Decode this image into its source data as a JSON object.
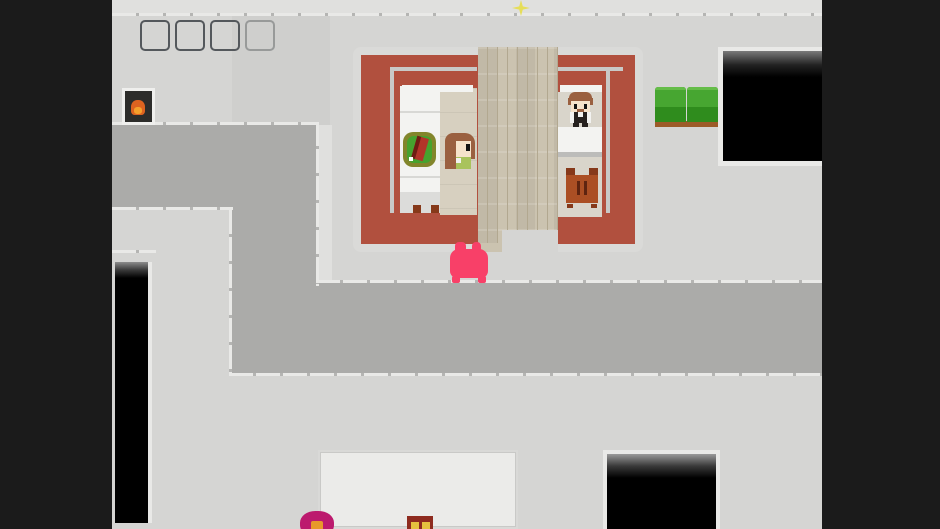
{
  "scene": {
    "type": "top-down pixel-art RPG town interior",
    "viewport": "letterboxed game view with dark bars left and right",
    "text_visible": "none"
  },
  "palette": {
    "letterbox": "#1b1b1b",
    "ground": "#d5d5d3",
    "ground_light": "#e0e0de",
    "ground_shade": "#cfcfcd",
    "road": "#ababa9",
    "trim": "#e9e9e7",
    "trim_tick": "#b5b5b3",
    "wall_trim": "#dadad8",
    "wall_red": "#b1503e",
    "inner_line": "#c9c9c7",
    "wood": "#cbc3b0",
    "wood_line": "#b2a890",
    "floor_left": "#d7d0c0",
    "floor_right": "#d9d5cb",
    "white_furn": "#f3f3f1",
    "furn_seam": "#d8d8d5",
    "bed_foot": "#dcdcda",
    "counter_shadow": "#bcbcba",
    "sofa_top": "#47a631",
    "sofa_bevel": "#65bd48",
    "sofa_front": "#2f8c1d",
    "sofa_base": "#9c5b28",
    "slime_pink": "#f84068",
    "firebox": "#2c2c2a",
    "firebox_frame": "#efefed",
    "flame": "#dd6320",
    "flame_bright": "#f5a02b",
    "plate_ring": "#82852b",
    "plate_green": "#46a22e",
    "food_red": "#b23429",
    "food_dark": "#6f1c13",
    "hair": "#9a6040",
    "skin": "#f6e3cb",
    "eye": "#141414",
    "girl_shirt": "#a9c35c",
    "suit_black": "#26211f",
    "shirt_white": "#f2f2f0",
    "cabinet": "#ab4f24",
    "cabinet_dark": "#86391a",
    "cabinet_slit": "#5e2410",
    "building_white": "#ebebe9",
    "flower_magenta": "#bc1a6e",
    "flower_center": "#e8992b",
    "chest_red": "#8e2b1f",
    "chest_gold": "#e5c23e",
    "sparkle": "#e6de58",
    "frame_gray": "#54585c"
  },
  "entities": [
    {
      "name": "player-slime",
      "kind": "pink slime creature",
      "location": "standing at south door of red-walled house"
    },
    {
      "name": "npc-girl",
      "kind": "girl with long brown hair and green top",
      "location": "left room beside bed and food plate"
    },
    {
      "name": "npc-bartender",
      "kind": "man in black vest and white shirt",
      "location": "right room behind white counter"
    },
    {
      "name": "sparkle",
      "kind": "yellow four-point star pickup",
      "location": "top wall, center"
    },
    {
      "name": "fireplace",
      "kind": "dark stove with orange flame",
      "location": "upper left"
    },
    {
      "name": "window-frame-outlines",
      "kind": "four gray square outlines",
      "location": "top left pavement"
    },
    {
      "name": "food-plate",
      "kind": "green plate with red roast",
      "location": "on white bed/counter, left room"
    },
    {
      "name": "bed",
      "kind": "long white bed with gray foot section",
      "location": "left room"
    },
    {
      "name": "shop-counter",
      "kind": "white counter",
      "location": "right room"
    },
    {
      "name": "cabinet",
      "kind": "brown two-door cabinet",
      "location": "right room, below counter"
    },
    {
      "name": "sofa",
      "kind": "green two-seat couch with brown base",
      "location": "right of house"
    },
    {
      "name": "dark-room-entrance",
      "kind": "black unexplored room",
      "location": "top right"
    },
    {
      "name": "dark-doorway",
      "kind": "black doorway opening",
      "location": "bottom center-right"
    },
    {
      "name": "white-roof-building",
      "kind": "pale flat roof",
      "location": "bottom center, cut off"
    },
    {
      "name": "flower",
      "kind": "magenta flower with orange center",
      "location": "bottom edge, cut off"
    },
    {
      "name": "chest",
      "kind": "dark red chest with gold panels",
      "location": "bottom edge, cut off"
    },
    {
      "name": "black-pit",
      "kind": "black void strip",
      "location": "lower left"
    },
    {
      "name": "roads",
      "kind": "darker gray L-shaped road/plaza",
      "location": "left band and bottom band"
    }
  ]
}
